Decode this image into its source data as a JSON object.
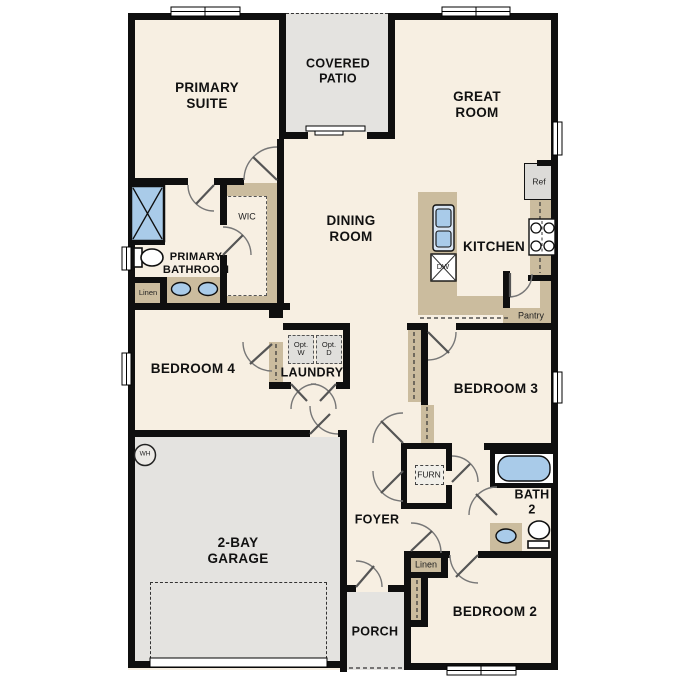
{
  "plan_title": "single-story floor plan",
  "colors": {
    "floor": "#f7efe2",
    "outdoor_concrete": "#e4e3e0",
    "cabinet_tan": "#cbbc9e",
    "fixture_blue": "#a9cbe9",
    "wall_black": "#0f0f0f"
  },
  "rooms": {
    "primary_suite": {
      "label": "PRIMARY\nSUITE"
    },
    "covered_patio": {
      "label": "COVERED\nPATIO"
    },
    "great_room": {
      "label": "GREAT\nROOM"
    },
    "dining_room": {
      "label": "DINING\nROOM"
    },
    "kitchen": {
      "label": "KITCHEN"
    },
    "primary_bathroom": {
      "label": "PRIMARY\nBATHROOM"
    },
    "wic": {
      "label": "WIC"
    },
    "bedroom_4": {
      "label": "BEDROOM 4"
    },
    "laundry": {
      "label": "LAUNDRY"
    },
    "bedroom_3": {
      "label": "BEDROOM 3"
    },
    "bath_2": {
      "label": "BATH\n2"
    },
    "foyer": {
      "label": "FOYER"
    },
    "garage": {
      "label": "2-BAY\nGARAGE"
    },
    "porch": {
      "label": "PORCH"
    },
    "bedroom_2": {
      "label": "BEDROOM 2"
    }
  },
  "features": {
    "ref": "Ref",
    "dw": "DW",
    "pantry": "Pantry",
    "linen_bath": "Linen",
    "linen_hall": "Linen",
    "opt_washer": "Opt.\nW",
    "opt_dryer": "Opt.\nD",
    "furnace": "FURN",
    "water_heater": "WH"
  },
  "fixtures": [
    "shower",
    "toilet",
    "double-vanity-sinks",
    "kitchen-island-sink",
    "dishwasher",
    "refrigerator",
    "range-burners",
    "bathtub",
    "vanity-sink",
    "toilet-2",
    "water-heater",
    "furnace",
    "washer-optional",
    "dryer-optional"
  ]
}
